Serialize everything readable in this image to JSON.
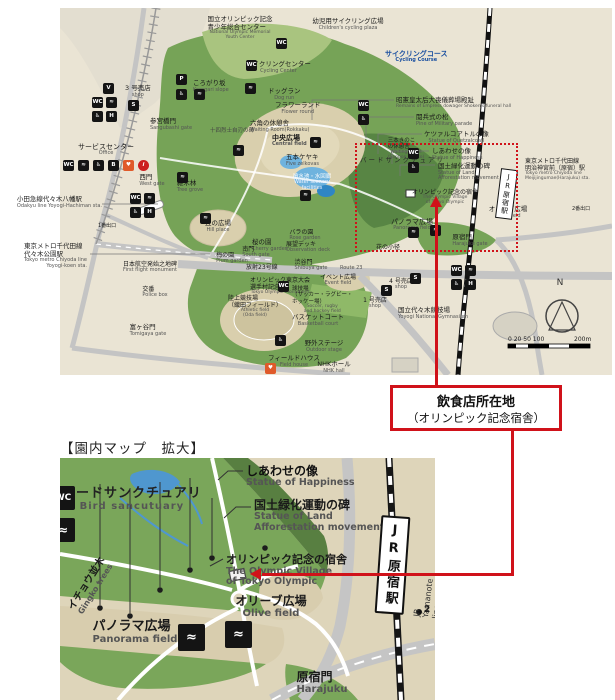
{
  "colors": {
    "red_accent": "#d0121a",
    "map_background": "#eae4d4",
    "park_green": "#76a357",
    "dark_green": "#588544",
    "light_green": "#a9c47f",
    "plaza_tan": "#d9cfad",
    "pond_blue": "#6fb3de",
    "road_gray": "#c4c4c4",
    "rail_black": "#161616",
    "blue_text": "#1a4fa0",
    "aed_orange": "#e05a2a"
  },
  "callout": {
    "line1": "飲食店所在地",
    "line2": "（オリンピック記念宿舎）"
  },
  "section_title": "【園内マップ　拡大】",
  "icon_glyphs": {
    "toilet": "WC",
    "fountain": "≈",
    "wheelchair": "♿",
    "vending": "V",
    "washstand": "H",
    "parking": "P",
    "shop": "S",
    "aed": "♥",
    "info": "i",
    "baby": "B"
  },
  "main_map": {
    "station_jr": "JR原宿駅",
    "labels": [
      {
        "t": "国立オリンピック記念\n青少年総合センター",
        "en": "National Olympic Memorial\nYouth Center",
        "x": 180,
        "y": 8,
        "fs": 6.5,
        "en_fs": 4.5,
        "align": "c"
      },
      {
        "t": "幼児用サイクリング広場",
        "en": "Children's cycling plaza",
        "x": 288,
        "y": 10,
        "fs": 6.5,
        "align": "c"
      },
      {
        "t": "サイクリングコース",
        "en": "Cycling Course",
        "x": 325,
        "y": 42,
        "fs": 7,
        "bold": true,
        "color": "#1a4fa0",
        "en_color": "#1a4fa0"
      },
      {
        "t": "サイクリングセンター",
        "en": "Cycling Center",
        "x": 186,
        "y": 53,
        "fs": 6.5
      },
      {
        "t": "ころがり坂",
        "en": "Korogari slope",
        "x": 133,
        "y": 72,
        "fs": 6.5
      },
      {
        "t": "ドッグラン",
        "en": "Dog run",
        "x": 208,
        "y": 80,
        "fs": 6.5
      },
      {
        "t": "フラワーランド",
        "en": "Flower round",
        "x": 215,
        "y": 94,
        "fs": 6.5
      },
      {
        "t": "3 号売店",
        "en": "shop",
        "x": 65,
        "y": 77,
        "fs": 6.5
      },
      {
        "t": "参宮橋門",
        "en": "Sangubashi gate",
        "x": 90,
        "y": 110,
        "fs": 6.5
      },
      {
        "t": "六角の休憩舎",
        "en": "Waiting Room(Rokkaku)",
        "x": 190,
        "y": 112,
        "fs": 6.5
      },
      {
        "t": "中央広場",
        "en": "Central field",
        "x": 212,
        "y": 126,
        "fs": 7,
        "bold": true
      },
      {
        "t": "五本ケヤキ",
        "en": "Five zelkovas",
        "x": 226,
        "y": 146,
        "fs": 6.5
      },
      {
        "t": "サービスセンター",
        "en": "Office",
        "x": 18,
        "y": 135,
        "fs": 7
      },
      {
        "t": "十四烈士自刃の碑",
        "x": 150,
        "y": 120,
        "fs": 5.5,
        "color": "#444"
      },
      {
        "t": "昭憲皇太后大喪儀葬場殿趾",
        "en": "Remains of Empress dowager Shoken's funeral hall",
        "x": 336,
        "y": 89,
        "fs": 6.5,
        "en_fs": 4.5
      },
      {
        "t": "閲兵式の松",
        "en": "Pine of Military parade",
        "x": 356,
        "y": 106,
        "fs": 6.5
      },
      {
        "t": "ケツァルコアトルの像",
        "en": "Statue of Quetzalcoatl",
        "x": 364,
        "y": 123,
        "fs": 6.5
      },
      {
        "t": "しあわせの像",
        "en": "Statue of Happiness",
        "x": 372,
        "y": 140,
        "fs": 6.5
      },
      {
        "t": "国土緑化運動の碑",
        "en": "Statue of Land\nAfforestation movement",
        "x": 378,
        "y": 155,
        "fs": 6.5,
        "en_align": "left"
      },
      {
        "t": "オリンピック記念の宿舎",
        "en": "The Olympic Village\nof Tokyo Olympic",
        "x": 352,
        "y": 181,
        "fs": 6,
        "en_fs": 4.5
      },
      {
        "t": "オリーブ広場",
        "en": "Olive field",
        "x": 448,
        "y": 198,
        "fs": 6.5,
        "align": "c"
      },
      {
        "t": "パノラマ広場",
        "en": "Panorama field",
        "x": 352,
        "y": 210,
        "fs": 7,
        "align": "c"
      },
      {
        "t": "バードサンクチュアリ",
        "x": 300,
        "y": 149,
        "fs": 6.5,
        "ls": 2,
        "color": "#2b2b2b"
      },
      {
        "t": "東京メトロ千代田線\n明治神宮前（原宿）駅",
        "en": "Tokyo metro Chiyoda line\nMeijijingumae(Harajuku) sta.",
        "x": 465,
        "y": 150,
        "fs": 6,
        "en_fs": 4.5,
        "en_align": "left"
      },
      {
        "t": "2番出口",
        "x": 512,
        "y": 199,
        "fs": 5
      },
      {
        "t": "小田急線代々木八幡駅",
        "en": "Odakyu line Yoyogi-Hachiman sta.",
        "x": 42,
        "y": 188,
        "fs": 6.5,
        "align": "r",
        "en_align": "right"
      },
      {
        "t": "東京メトロ千代田線\n代々木公園駅",
        "en": "Tokyo metro Chiyoda line\nYoyogi-koen sta.",
        "x": 27,
        "y": 235,
        "fs": 6.5,
        "align": "r",
        "en_align": "right"
      },
      {
        "t": "1番出口",
        "x": 38,
        "y": 216,
        "fs": 5
      },
      {
        "t": "西門",
        "en": "West gate",
        "x": 92,
        "y": 166,
        "fs": 6.5,
        "align": "c"
      },
      {
        "t": "雑木林",
        "en": "Tree grove",
        "x": 130,
        "y": 172,
        "fs": 6.5,
        "align": "c"
      },
      {
        "t": "丘の広場",
        "en": "Hill place",
        "x": 158,
        "y": 212,
        "fs": 6.5,
        "align": "c"
      },
      {
        "t": "桜の園",
        "en": "Cherry garden",
        "x": 210,
        "y": 231,
        "fs": 6.5,
        "align": "c"
      },
      {
        "t": "梅の園",
        "en": "Plum garden",
        "x": 172,
        "y": 244,
        "fs": 6,
        "align": "c"
      },
      {
        "t": "南門",
        "en": "South gate",
        "x": 196,
        "y": 238,
        "fs": 6,
        "align": "c"
      },
      {
        "t": "日本航空発始之地碑",
        "en": "First flight monument",
        "x": 90,
        "y": 253,
        "fs": 6,
        "align": "c"
      },
      {
        "t": "放射23号線",
        "x": 186,
        "y": 256,
        "fs": 6
      },
      {
        "t": "Route 23",
        "x": 280,
        "y": 258,
        "fs": 5,
        "color": "#555"
      },
      {
        "t": "交番",
        "en": "Police box",
        "x": 95,
        "y": 278,
        "fs": 6,
        "align": "c"
      },
      {
        "t": "オリンピック東京大会\n選手村記念碑",
        "en": "Tokyo Olympic monument",
        "x": 190,
        "y": 269,
        "fs": 6,
        "en_fs": 4.5
      },
      {
        "t": "陸上競技場\n（織田フィールド）",
        "en": "Athletic field\n(Oda field)",
        "x": 168,
        "y": 287,
        "fs": 6,
        "en_fs": 4.5
      },
      {
        "t": "球技場\n（サッカー・ラグビー・\nホッケー場）",
        "en": "Soccer, rugby\nand hockey field",
        "x": 232,
        "y": 278,
        "fs": 5.5,
        "en_fs": 4.5
      },
      {
        "t": "バスケットコート",
        "en": "Basketball court",
        "x": 232,
        "y": 306,
        "fs": 6.5
      },
      {
        "t": "富ヶ谷門",
        "en": "Tomigaya gate",
        "x": 88,
        "y": 316,
        "fs": 6.5,
        "align": "c"
      },
      {
        "t": "フィールドハウス",
        "en": "Field house",
        "x": 208,
        "y": 347,
        "fs": 6.5
      },
      {
        "t": "野外ステージ",
        "en": "Outdoor stage",
        "x": 264,
        "y": 332,
        "fs": 6.5,
        "align": "c"
      },
      {
        "t": "NHKホール",
        "en": "NHK hall",
        "x": 274,
        "y": 353,
        "fs": 6.5,
        "align": "c"
      },
      {
        "t": "イベント広場",
        "en": "Event field",
        "x": 278,
        "y": 266,
        "fs": 6,
        "align": "c"
      },
      {
        "t": "バラの園",
        "en": "Rose garden",
        "x": 245,
        "y": 221,
        "fs": 6,
        "align": "c"
      },
      {
        "t": "展望デッキ",
        "en": "Observation deck",
        "x": 248,
        "y": 233,
        "fs": 6,
        "align": "c"
      },
      {
        "t": "花の小径",
        "x": 316,
        "y": 236,
        "fs": 6
      },
      {
        "t": "渋谷門",
        "en": "Shibuya gate",
        "x": 251,
        "y": 251,
        "fs": 6,
        "align": "c"
      },
      {
        "t": "4 号売店",
        "en": "shop",
        "x": 341,
        "y": 270,
        "fs": 6,
        "align": "c"
      },
      {
        "t": "1 号売店",
        "en": "shop",
        "x": 315,
        "y": 289,
        "fs": 6,
        "align": "c"
      },
      {
        "t": "国立代々木競技場",
        "en": "Yoyogi National Gymnasium",
        "x": 338,
        "y": 299,
        "fs": 6.5
      },
      {
        "t": "原宿門",
        "en": "Harajuku gate",
        "x": 410,
        "y": 226,
        "fs": 6.5,
        "align": "c"
      },
      {
        "t": "三本きのこ\nの休憩舎",
        "en": "Waiting Room\n(Sanbon kinoko)",
        "x": 346,
        "y": 130,
        "fs": 5.5,
        "en_fs": 4.5,
        "align": "c"
      },
      {
        "t": "噴水池・水回廊",
        "en": "Water scenery\nfacilities",
        "x": 252,
        "y": 166,
        "fs": 5.5,
        "color": "#ffffff",
        "en_color": "#eef2ff",
        "align": "c"
      },
      {
        "t": "N",
        "x": 500,
        "y": 270,
        "fs": 9,
        "align": "c",
        "color": "#333"
      },
      {
        "t": "0 20  50    100",
        "x": 448,
        "y": 328,
        "fs": 6,
        "color": "#222"
      },
      {
        "t": "200m",
        "x": 514,
        "y": 328,
        "fs": 6,
        "color": "#222"
      }
    ],
    "icons": [
      {
        "t": "vending",
        "x": 43,
        "y": 75
      },
      {
        "t": "toilet",
        "x": 32,
        "y": 89
      },
      {
        "t": "fountain",
        "x": 46,
        "y": 89
      },
      {
        "t": "wheelchair",
        "x": 32,
        "y": 103
      },
      {
        "t": "washstand",
        "x": 46,
        "y": 103
      },
      {
        "t": "shop",
        "x": 68,
        "y": 92
      },
      {
        "t": "parking",
        "x": 116,
        "y": 66
      },
      {
        "t": "wheelchair",
        "x": 116,
        "y": 81
      },
      {
        "t": "fountain",
        "x": 134,
        "y": 81
      },
      {
        "t": "toilet",
        "x": 186,
        "y": 52
      },
      {
        "t": "toilet",
        "x": 216,
        "y": 30
      },
      {
        "t": "fountain",
        "x": 185,
        "y": 75
      },
      {
        "t": "toilet",
        "x": 298,
        "y": 92
      },
      {
        "t": "wheelchair",
        "x": 298,
        "y": 106
      },
      {
        "t": "fountain",
        "x": 173,
        "y": 137
      },
      {
        "t": "fountain",
        "x": 250,
        "y": 129
      },
      {
        "t": "fountain",
        "x": 240,
        "y": 182
      },
      {
        "t": "toilet",
        "x": 348,
        "y": 140
      },
      {
        "t": "wheelchair",
        "x": 348,
        "y": 154
      },
      {
        "t": "toilet",
        "x": 70,
        "y": 185
      },
      {
        "t": "fountain",
        "x": 84,
        "y": 185
      },
      {
        "t": "wheelchair",
        "x": 70,
        "y": 199
      },
      {
        "t": "washstand",
        "x": 84,
        "y": 199
      },
      {
        "t": "fountain",
        "x": 117,
        "y": 164
      },
      {
        "t": "fountain",
        "x": 140,
        "y": 205
      },
      {
        "t": "toilet",
        "x": 3,
        "y": 152
      },
      {
        "t": "fountain",
        "x": 18,
        "y": 152
      },
      {
        "t": "wheelchair",
        "x": 33,
        "y": 152
      },
      {
        "t": "baby",
        "x": 48,
        "y": 152
      },
      {
        "t": "aed",
        "x": 63,
        "y": 152
      },
      {
        "t": "info",
        "x": 78,
        "y": 152
      },
      {
        "t": "toilet",
        "x": 218,
        "y": 273
      },
      {
        "t": "wheelchair",
        "x": 215,
        "y": 327
      },
      {
        "t": "toilet",
        "x": 391,
        "y": 257
      },
      {
        "t": "fountain",
        "x": 405,
        "y": 257
      },
      {
        "t": "wheelchair",
        "x": 391,
        "y": 271
      },
      {
        "t": "washstand",
        "x": 405,
        "y": 271
      },
      {
        "t": "shop",
        "x": 350,
        "y": 265
      },
      {
        "t": "shop",
        "x": 321,
        "y": 277
      },
      {
        "t": "fountain",
        "x": 348,
        "y": 219
      },
      {
        "t": "fountain",
        "x": 370,
        "y": 217
      },
      {
        "t": "aed",
        "x": 205,
        "y": 355
      }
    ]
  },
  "detail_map": {
    "station_jr": "JR原宿駅",
    "exit_number": "2",
    "labels": [
      {
        "t": "バードサンクチュアリ",
        "en": "Bird sancutuary",
        "x": 2,
        "y": 28,
        "fs": 13,
        "bold": true,
        "ls": 1,
        "en_fs": 10,
        "color": "#222"
      },
      {
        "t": "しあわせの像",
        "en": "Statue of Happiness",
        "x": 186,
        "y": 6,
        "fs": 12,
        "bold": true,
        "en_fs": 9.5,
        "en_align": "left",
        "color": "#111"
      },
      {
        "t": "国土緑化運動の碑",
        "en": "Statue of Land\nAfforestation movement",
        "x": 194,
        "y": 40,
        "fs": 12,
        "bold": true,
        "en_fs": 9.5,
        "en_align": "left"
      },
      {
        "t": "オリンピック記念の宿舎",
        "en": "The Olympic Village\nof Tokyo Olympic",
        "x": 166,
        "y": 96,
        "fs": 11,
        "bold": true,
        "en_fs": 9.5,
        "en_align": "left"
      },
      {
        "t": "オリーブ広場",
        "en": "Olive field",
        "x": 211,
        "y": 136,
        "fs": 12,
        "bold": true,
        "en_fs": 10,
        "align": "c"
      },
      {
        "t": "パノラマ広場",
        "en": "Panorama field",
        "x": 75,
        "y": 161,
        "fs": 13,
        "bold": true,
        "en_fs": 10,
        "align": "c"
      },
      {
        "t": "イチョウ並木",
        "en": "Gingko trees",
        "x": 31,
        "y": 118,
        "fs": 10,
        "bold": true,
        "en_fs": 8,
        "align": "c",
        "rot": -58
      },
      {
        "t": "原宿門",
        "en": "Harajuku",
        "x": 262,
        "y": 212,
        "fs": 12,
        "bold": true,
        "en_fs": 10,
        "align": "c"
      },
      {
        "t": "JR Yamanote line Harajuku sta.",
        "x": 352,
        "y": 158,
        "fs": 8,
        "rot": -83,
        "color": "#333"
      },
      {
        "t": "2",
        "x": 364,
        "y": 147,
        "fs": 9,
        "bold": true
      }
    ],
    "icons": [
      {
        "t": "toilet",
        "x": -9,
        "y": 28,
        "s": 24,
        "fs": 9
      },
      {
        "t": "fountain",
        "x": -9,
        "y": 60,
        "s": 24,
        "fs": 12
      },
      {
        "t": "fountain",
        "x": 118,
        "y": 166,
        "s": 27,
        "fs": 13
      },
      {
        "t": "fountain",
        "x": 165,
        "y": 163,
        "s": 27,
        "fs": 13
      }
    ]
  }
}
